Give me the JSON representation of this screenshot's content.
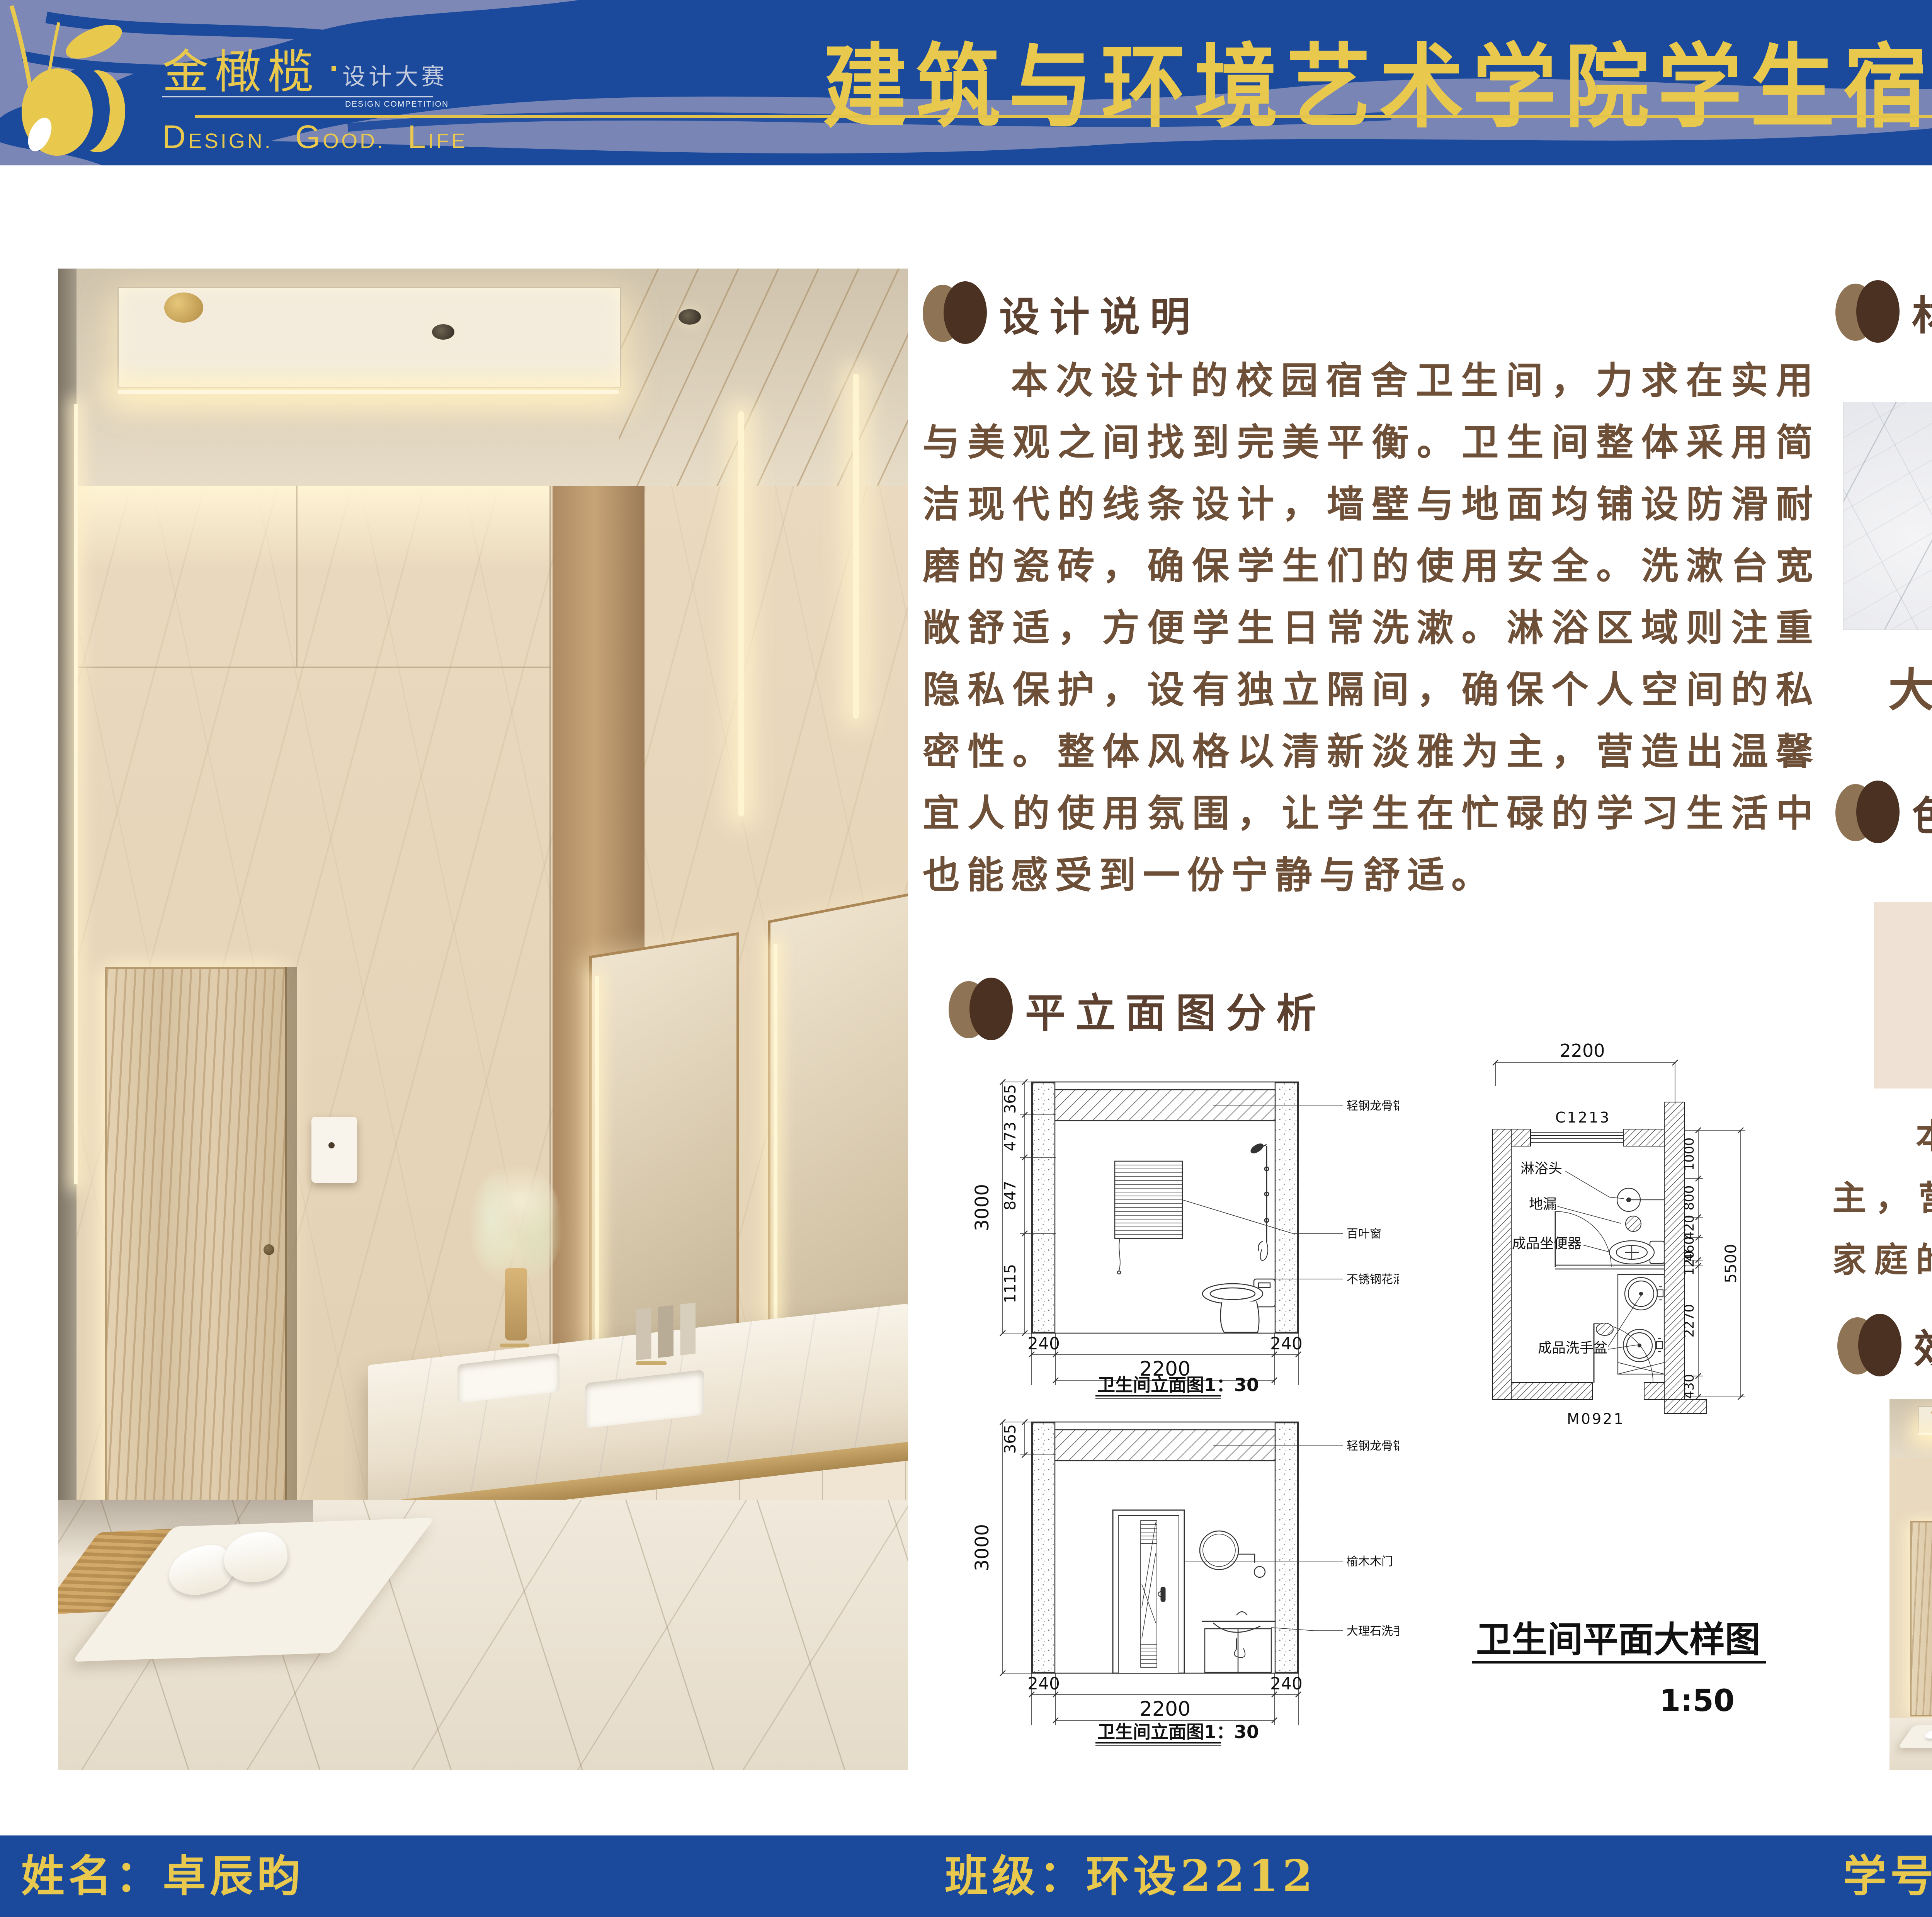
{
  "palette": {
    "banner_blue": "#1B4A9C",
    "wave_lavender": "#858DB8",
    "gold": "#E9C84E",
    "heading_brown": "#5C4130",
    "icon_light_brown": "#8E7355",
    "icon_dark_brown": "#4B3121",
    "body_brown": "#6E4F37"
  },
  "header": {
    "brand": "金橄榄",
    "brand_dot": "·",
    "brand_sub": "设计大赛",
    "brand_sub_en": "DESIGN COMPETITION",
    "tagline": {
      "w1": "Design.",
      "w2": "Good.",
      "w3": "Life"
    },
    "title": "建筑与环境艺术学院学生宿舍卫生间设计大赛"
  },
  "sections": {
    "design": {
      "heading": "设计说明",
      "body": "本次设计的校园宿舍卫生间，力求在实用与美观之间找到完美平衡。卫生间整体采用简洁现代的线条设计，墙壁与地面均铺设防滑耐磨的瓷砖，确保学生们的使用安全。洗漱台宽敞舒适，方便学生日常洗漱。淋浴区域则注重隐私保护，设有独立隔间，确保个人空间的私密性。整体风格以清新淡雅为主，营造出温馨宜人的使用氛围，让学生在忙碌的学习生活中也能感受到一份宁静与舒适。"
    },
    "plans": {
      "heading": "平立面图分析",
      "elev1": {
        "title": "卫生间立面图1：30",
        "left_dims": [
          "365",
          "473",
          "847",
          "1115"
        ],
        "left_total": "3000",
        "bottom_dims": [
          "240",
          "2200",
          "240"
        ],
        "ann": [
          "轻钢龙骨铝扣板吊顶",
          "百叶窗",
          "不锈钢花洒"
        ]
      },
      "elev2": {
        "title": "卫生间立面图1：30",
        "left_dims": [
          "365"
        ],
        "left_total": "3000",
        "bottom_dims": [
          "240",
          "2200",
          "240"
        ],
        "ann": [
          "轻钢龙骨铝扣板吊顶",
          "榆木木门",
          "大理石洗手台"
        ]
      },
      "plan": {
        "title": "卫生间平面大样图",
        "scale": "1:50",
        "top_dim": "2200",
        "window_code": "C1213",
        "door_code": "M0921",
        "right_dims": [
          "1000",
          "800",
          "420",
          "460",
          "120",
          "2270",
          "430"
        ],
        "right_total": "5500",
        "labels": [
          "淋浴头",
          "地漏",
          "成品坐便器",
          "成品洗手盆"
        ]
      }
    },
    "materials": {
      "heading": "材质分析",
      "items": [
        {
          "label": "大理石",
          "texture": "marble"
        },
        {
          "label": "榆木",
          "texture": "elm-wood"
        },
        {
          "label": "磨砂玻璃",
          "texture": "frosted-glass"
        }
      ]
    },
    "colors": {
      "heading": "色彩分析",
      "swatches": [
        "#F0E1D5",
        "#CBB8A9",
        "#AC9870",
        "#695141"
      ],
      "body": "本次设计的校园宿舍卫生间，以暖色调为主，营造出温馨的宿舍环境，给予学生们一种家庭的温暖舒适感。"
    },
    "renders": {
      "heading": "效果图展示"
    }
  },
  "footer": {
    "name": "姓名：卓辰昀",
    "class": "班级：环设2212",
    "student_id": "学号：202240348"
  }
}
